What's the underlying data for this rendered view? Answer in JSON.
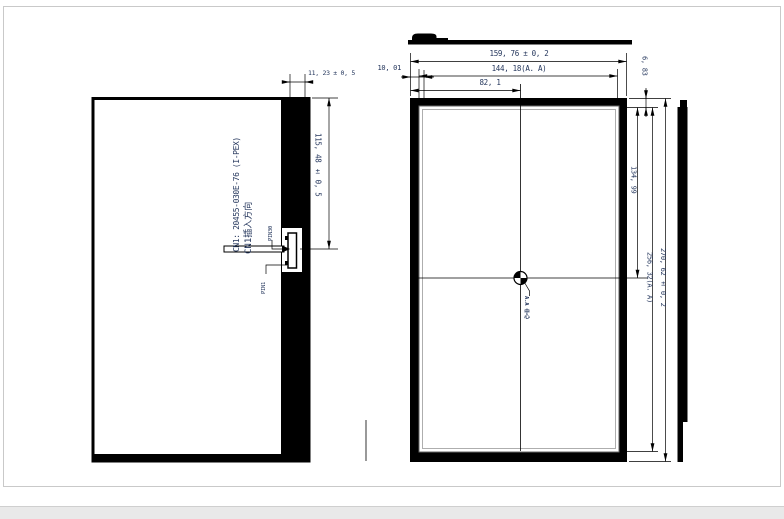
{
  "page": {
    "background": "#ffffff",
    "line_color": "#000000",
    "text_color": "#24365c"
  },
  "left_view": {
    "connector_label": "CN1: 20455-030E-76 (I-PEX)",
    "insertion_label": "CN1插入方向",
    "pin_top": "PIN30",
    "pin_bottom": "PIN1",
    "dim_connector_offset": "11, 23 ± 0, 5",
    "dim_connector_position": "115, 48 ± 0, 5"
  },
  "right_view": {
    "dim_outline_width": "159, 76 ± 0, 2",
    "dim_active_area_width": "144, 18(A. A)",
    "dim_center_from_left": "82, 1",
    "dim_left_bezel": "10, 01",
    "dim_top_bezel": "6, 83",
    "dim_center_from_top": "134, 99",
    "dim_active_area_height": "256, 32(A. A)",
    "dim_outline_height": "270, 62 ± 0, 2",
    "center_mark_label": "A.A 中心"
  }
}
